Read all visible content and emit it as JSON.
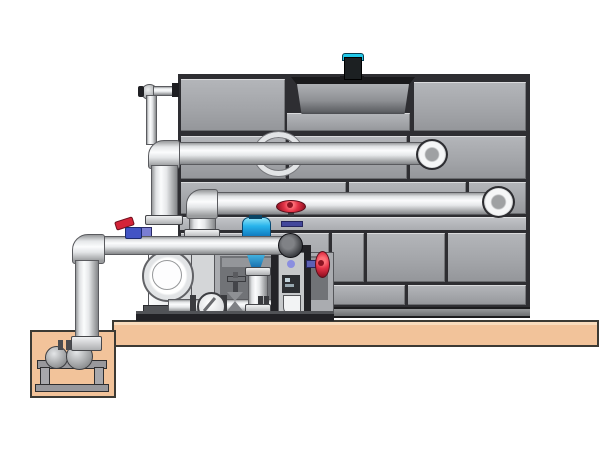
{
  "diagram": {
    "type": "technical illustration",
    "subject": "Closed circuit cooling tower with circulation pump skid, control valves and sump pump pit",
    "text_labels": [],
    "canvas": {
      "width": 600,
      "height": 450,
      "background": "#ffffff"
    }
  },
  "palette": {
    "casing_panel": "#a6a8ac",
    "casing_seam": "#2e2e32",
    "casing_stringer": "#b6b8bc",
    "fan_shroud_rim": "#1a1a1c",
    "fan_shroud_body": "#8e9094",
    "motor_cyan": "#22c8e8",
    "motor_black": "#1c2022",
    "pipe_highlight": "#fbfcfd",
    "pipe_shadow": "#8c8e90",
    "pipe_outline": "#5a5b5f",
    "platform_tan": "#f2c39a",
    "pit_inner_tan": "#f6d0ac",
    "ground_outline": "#3c3a34",
    "handwheel_red": "#d42438",
    "valve_purple": "#5c60b4",
    "actuator_blue": "#28b4ec",
    "frame_black": "#232327",
    "pump_white": "#f2f3f4"
  },
  "styles": {
    "platform": "background:#f2c39a",
    "pit_inner": "background:#f6d0ac",
    "motor_cyan": "background:#22c8e8",
    "lever_red": "background:#d42438",
    "valve_purple": "background:#5c60b4"
  },
  "components": [
    {
      "id": "fan-motor",
      "label": "fan drive motor (cyan)"
    },
    {
      "id": "fan-shroud",
      "label": "fan cowl on tower roof"
    },
    {
      "id": "tower-casing",
      "label": "panelled cooling tower casing"
    },
    {
      "id": "makeup-line",
      "label": "small-bore make-up water line over casing edge"
    },
    {
      "id": "wall-sleeve",
      "label": "round wall sleeve behind upper pipe"
    },
    {
      "id": "upper-return-pipe",
      "label": "upper horizontal pipe with elbow cap"
    },
    {
      "id": "middle-distribution-pipe",
      "label": "middle horizontal pipe with elbow cap"
    },
    {
      "id": "suction-manifold",
      "label": "lower suction manifold with dark elbow"
    },
    {
      "id": "riser-pipe",
      "label": "vertical riser pipes"
    },
    {
      "id": "circulation-pump",
      "label": "centrifugal circulation pump with round inlet"
    },
    {
      "id": "check-valve",
      "label": "wafer disc valve on skid piping"
    },
    {
      "id": "drain-gate-valve",
      "label": "small gate valve with cross handle"
    },
    {
      "id": "control-valve",
      "label": "automatic control valve with blue actuator"
    },
    {
      "id": "red-gate-valve",
      "label": "gate valve with red handwheel on manifold end"
    },
    {
      "id": "side-handwheel-valve",
      "label": "side mounted red handwheel valve"
    },
    {
      "id": "lever-ball-valve",
      "label": "quarter-turn lever valve with red handle"
    },
    {
      "id": "instrument-frame",
      "label": "black instrument and valve support frame"
    },
    {
      "id": "pump-skid",
      "label": "dark equipment skid base"
    },
    {
      "id": "platform",
      "label": "tan housekeeping pad"
    },
    {
      "id": "sump-pit",
      "label": "below-grade sump pit"
    },
    {
      "id": "sump-pump",
      "label": "sump transfer pump on stand"
    },
    {
      "id": "suction-downpipe",
      "label": "vertical suction pipe into sump"
    }
  ]
}
